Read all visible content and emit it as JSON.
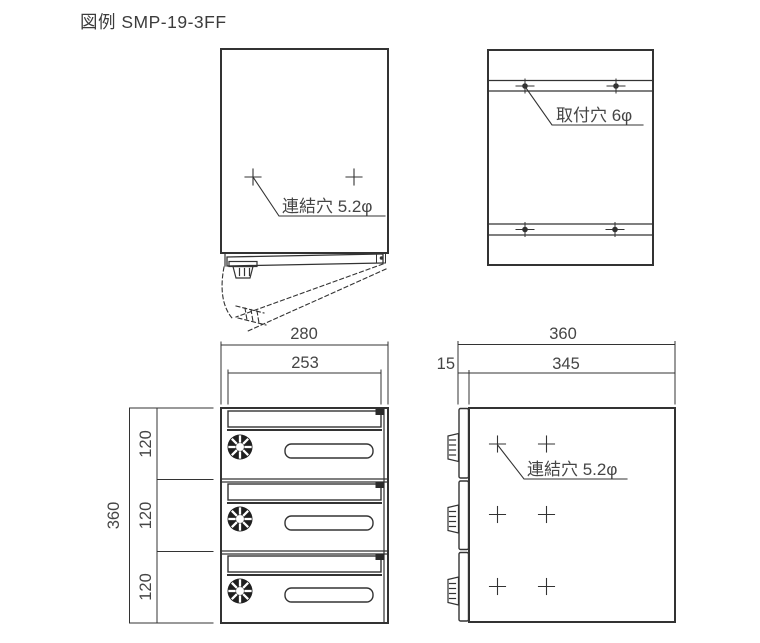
{
  "title": "図例 SMP-19-3FF",
  "colors": {
    "line": "#333333",
    "text": "#454545",
    "background": "#ffffff"
  },
  "top_view": {
    "annotation_link_hole": "連結穴 5.2φ"
  },
  "back_view": {
    "annotation_mount_hole": "取付穴 6φ"
  },
  "front_view": {
    "dim_overall_width": "280",
    "dim_inner_width": "253",
    "dim_overall_height": "360",
    "dim_row_heights": [
      "120",
      "120",
      "120"
    ],
    "compartment_count": 3
  },
  "side_view": {
    "dim_overall_depth": "360",
    "dim_door_offset": "15",
    "dim_body_depth": "345",
    "annotation_link_hole": "連結穴 5.2φ"
  }
}
